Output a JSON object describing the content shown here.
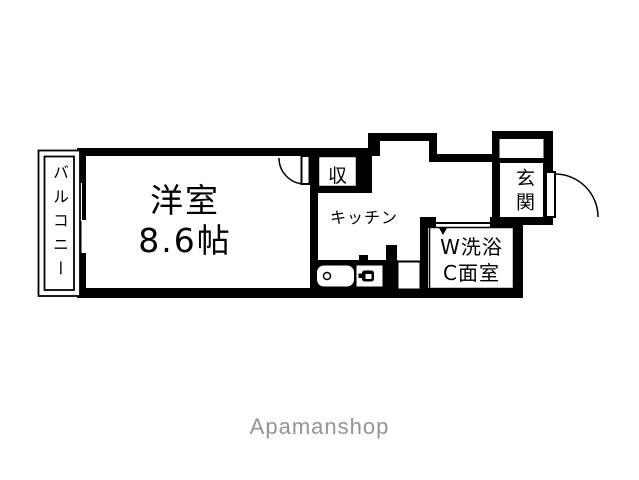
{
  "floorplan": {
    "balcony_label": "バルコニー",
    "room_label": "洋室",
    "room_size": "8.6帖",
    "closet_label": "収",
    "kitchen_label": "キッチン",
    "entrance_label": "玄関",
    "bathroom_line1": "W洗浴",
    "bathroom_line2": "C面室"
  },
  "watermark": "Apamanshop",
  "colors": {
    "wall": "#000000",
    "floor": "#ffffff",
    "watermark_gray": "#949494"
  }
}
